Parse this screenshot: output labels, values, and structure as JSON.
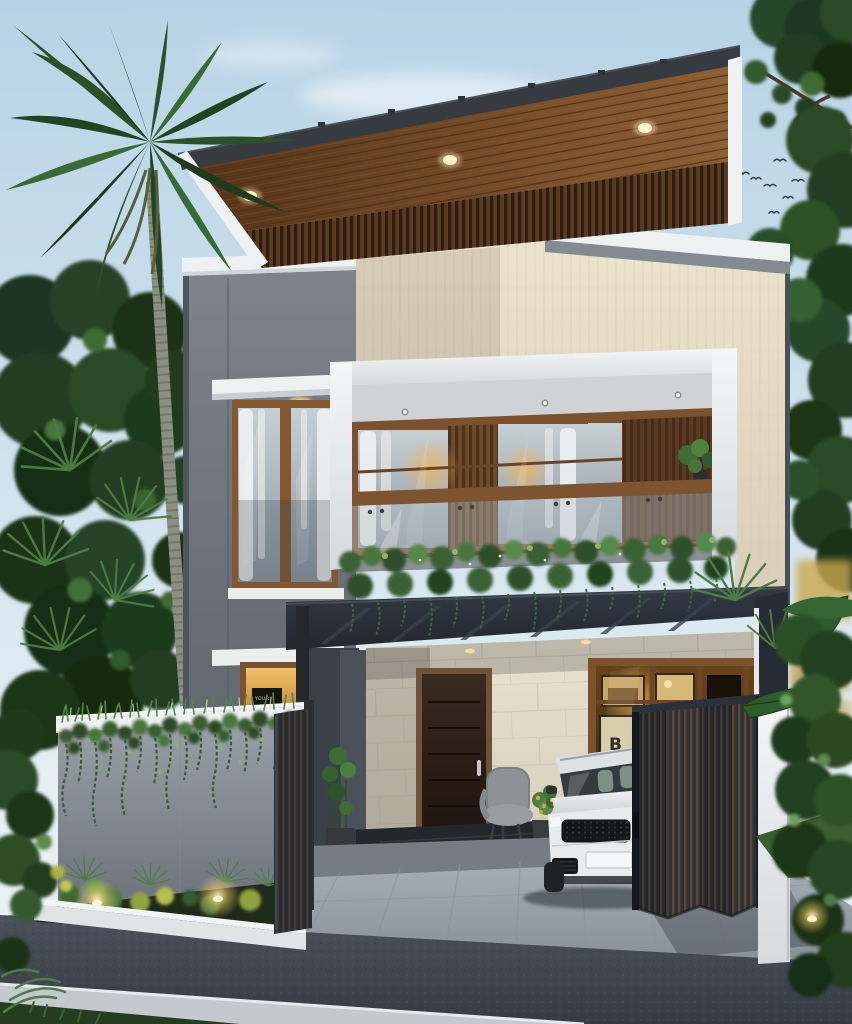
{
  "texts": {
    "tv_screen": "YOUR",
    "artwork_letter": "B"
  },
  "palette": {
    "sky_top": "#b8d3e6",
    "sky_bottom": "#e9f1f5",
    "roof_fascia": "#363b42",
    "wood_soffit": "#7a4c28",
    "wall_gray": "#6e747c",
    "travertine": "#e6dcc6",
    "canopy_dark": "#2a3038",
    "stone_wall": "#e3dccb",
    "door_wood": "#2f2118",
    "foliage_dark": "#2c4527",
    "foliage_light": "#5d8a4e",
    "warm_light": "#f2b24a",
    "car_body": "#e7ebed",
    "gate_dark": "#20262d",
    "gate_slat_wood": "#6b4a2c",
    "white_trim": "#eef1f2",
    "road": "#40474f",
    "driveway": "#9ba3ab"
  }
}
